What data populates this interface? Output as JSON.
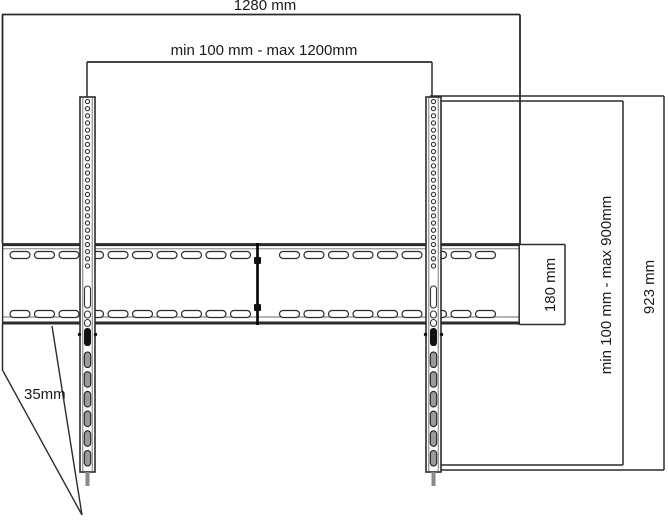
{
  "labels": {
    "total_width": "1280 mm",
    "arm_span_range": "min 100 mm - max 1200mm",
    "plate_height": "180 mm",
    "vertical_range": "min 100 mm - max 900mm",
    "rail_length": "923 mm",
    "depth": "35mm"
  },
  "colors": {
    "line": "#2b2b2b",
    "line_light": "#6a6a6a",
    "fill": "#ffffff",
    "slot_fill": "#9a9a9a",
    "tail_fill": "#8a8a8a",
    "clamp_fill": "#111111",
    "text": "#1a1a1a",
    "background": "#ffffff"
  }
}
